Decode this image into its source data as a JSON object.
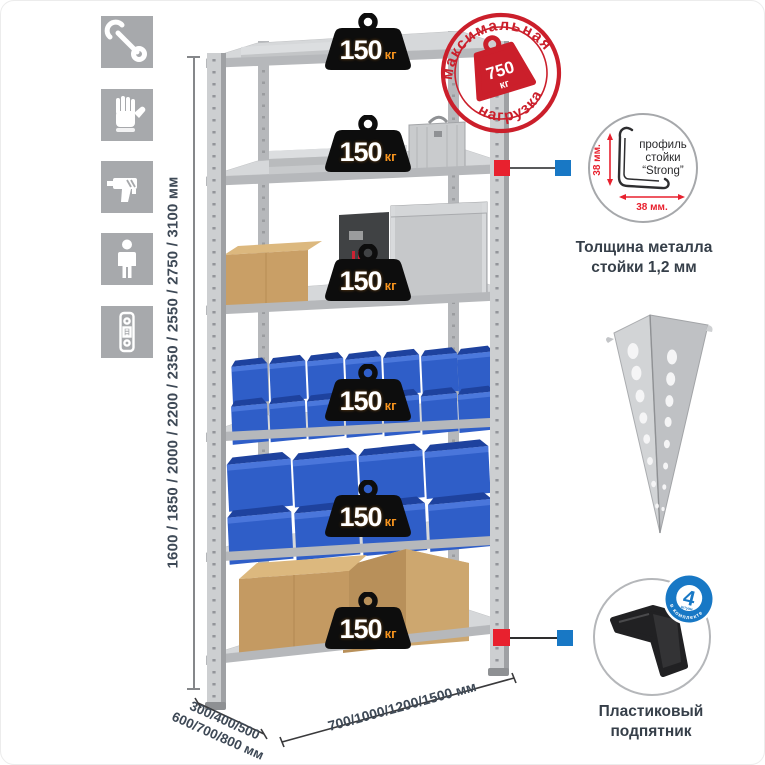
{
  "title": "Металлический стеллаж — инфографика",
  "sidebar": {
    "icons": [
      {
        "name": "wrench"
      },
      {
        "name": "gloves"
      },
      {
        "name": "drill"
      },
      {
        "name": "person"
      },
      {
        "name": "perforated-post"
      }
    ]
  },
  "dimensions": {
    "height_label": "1600 / 1850 / 2000 / 2200 / 2350 / 2550 / 2750 / 3100 мм",
    "depth_label_line1": "300/400/500",
    "depth_label_line2": "600/700/800 мм",
    "width_label": "700/1000/1200/1500 мм"
  },
  "shelves": [
    {
      "load": "150",
      "unit": "кг"
    },
    {
      "load": "150",
      "unit": "кг"
    },
    {
      "load": "150",
      "unit": "кг"
    },
    {
      "load": "150",
      "unit": "кг"
    },
    {
      "load": "150",
      "unit": "кг"
    },
    {
      "load": "150",
      "unit": "кг"
    }
  ],
  "stamp": {
    "arc_top": "максимальная",
    "arc_bottom": "нагрузка",
    "value": "750",
    "unit": "кг"
  },
  "profile_detail": {
    "line1": "профиль",
    "line2": "стойки",
    "line3": "“Strong”",
    "dim_vertical": "38 мм.",
    "dim_horizontal": "38 мм.",
    "caption_line1": "Толщина металла",
    "caption_line2": "стойки 1,2 мм"
  },
  "foot_detail": {
    "badge_value": "4",
    "badge_sub": "штуки",
    "badge_arc": "в комплекте",
    "caption_line1": "Пластиковый",
    "caption_line2": "подпятник"
  },
  "colors": {
    "stamp_red": "#cb1f2b",
    "marker_red": "#e8212e",
    "marker_blue": "#1878c5",
    "bin_blue": "#2f5ec8",
    "unit_orange": "#f7941e"
  }
}
